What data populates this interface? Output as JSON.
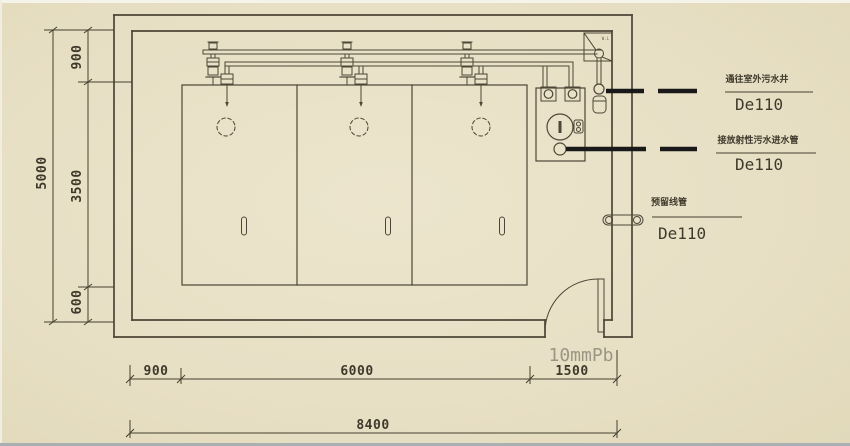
{
  "colors": {
    "background": "#e8e0c5",
    "line": "#4c4636",
    "pipe_black": "#191919",
    "muted_label": "#9b9585"
  },
  "dimensions": {
    "left": {
      "total": "5000",
      "segments": [
        "900",
        "3500",
        "600"
      ]
    },
    "bottom": {
      "total": "8400",
      "segments": [
        "900",
        "6000",
        "1500"
      ]
    }
  },
  "door": {
    "shielding_label": "10mmPb"
  },
  "funnel": {
    "label": "W.L"
  },
  "annotations": [
    {
      "text": "通往室外污水井",
      "spec": "De110"
    },
    {
      "text": "接放射性污水进水管",
      "spec": "De110"
    },
    {
      "text": "预留线管",
      "spec": "De110"
    }
  ]
}
